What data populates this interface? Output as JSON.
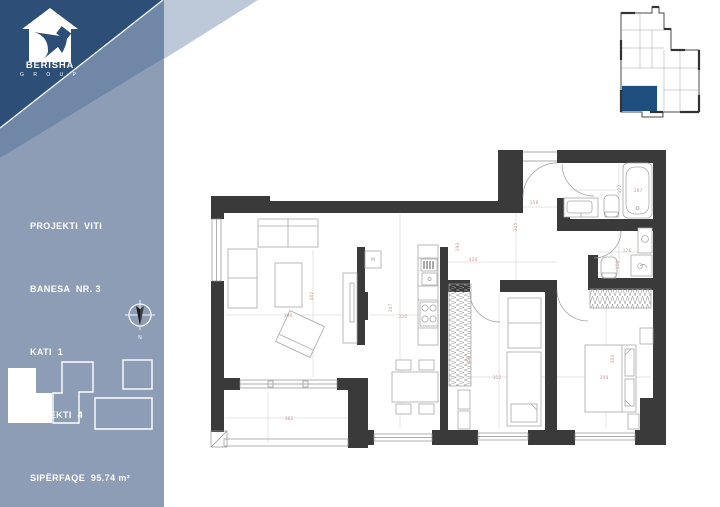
{
  "brand": {
    "name": "BERISHA",
    "group": "G R O U P"
  },
  "sidebar": {
    "info": [
      "PROJEKTI  VITI",
      "BANESA  NR. 3",
      "KATI  1",
      "OBJEKTI  4",
      "SIPËRFAQE  95.74 m²"
    ]
  },
  "compass": {
    "label": "N"
  },
  "plan": {
    "shaft_label": "M",
    "dimensions": [
      {
        "x": 288,
        "y": 317,
        "t": "390"
      },
      {
        "x": 313,
        "y": 296,
        "t": "462",
        "r": -90
      },
      {
        "x": 534,
        "y": 204,
        "t": "158"
      },
      {
        "x": 517,
        "y": 227,
        "t": "245",
        "r": -90
      },
      {
        "x": 473,
        "y": 261,
        "t": "420"
      },
      {
        "x": 459,
        "y": 247,
        "t": "193",
        "r": -90
      },
      {
        "x": 392,
        "y": 308,
        "t": "347",
        "r": -90
      },
      {
        "x": 403,
        "y": 318,
        "t": "220"
      },
      {
        "x": 638,
        "y": 192,
        "t": "287"
      },
      {
        "x": 621,
        "y": 189,
        "t": "172",
        "r": -90
      },
      {
        "x": 627,
        "y": 252,
        "t": "176"
      },
      {
        "x": 619,
        "y": 265,
        "t": "150",
        "r": -90
      },
      {
        "x": 497,
        "y": 379,
        "t": "312"
      },
      {
        "x": 470,
        "y": 360,
        "t": "358",
        "r": -90
      },
      {
        "x": 604,
        "y": 379,
        "t": "298"
      },
      {
        "x": 614,
        "y": 359,
        "t": "304",
        "r": -90
      },
      {
        "x": 289,
        "y": 420,
        "t": "382"
      }
    ]
  },
  "colors": {
    "navy": "#2c4e77",
    "slate": "#8e9db6",
    "slate_mid": "#7187a7",
    "pale": "#bdc9d8",
    "wall": "#3a3a3a",
    "accent": "#1e4e7d",
    "dim": "#c5a096",
    "furn": "#a8a8a8",
    "ref": "#dcdcdc"
  }
}
